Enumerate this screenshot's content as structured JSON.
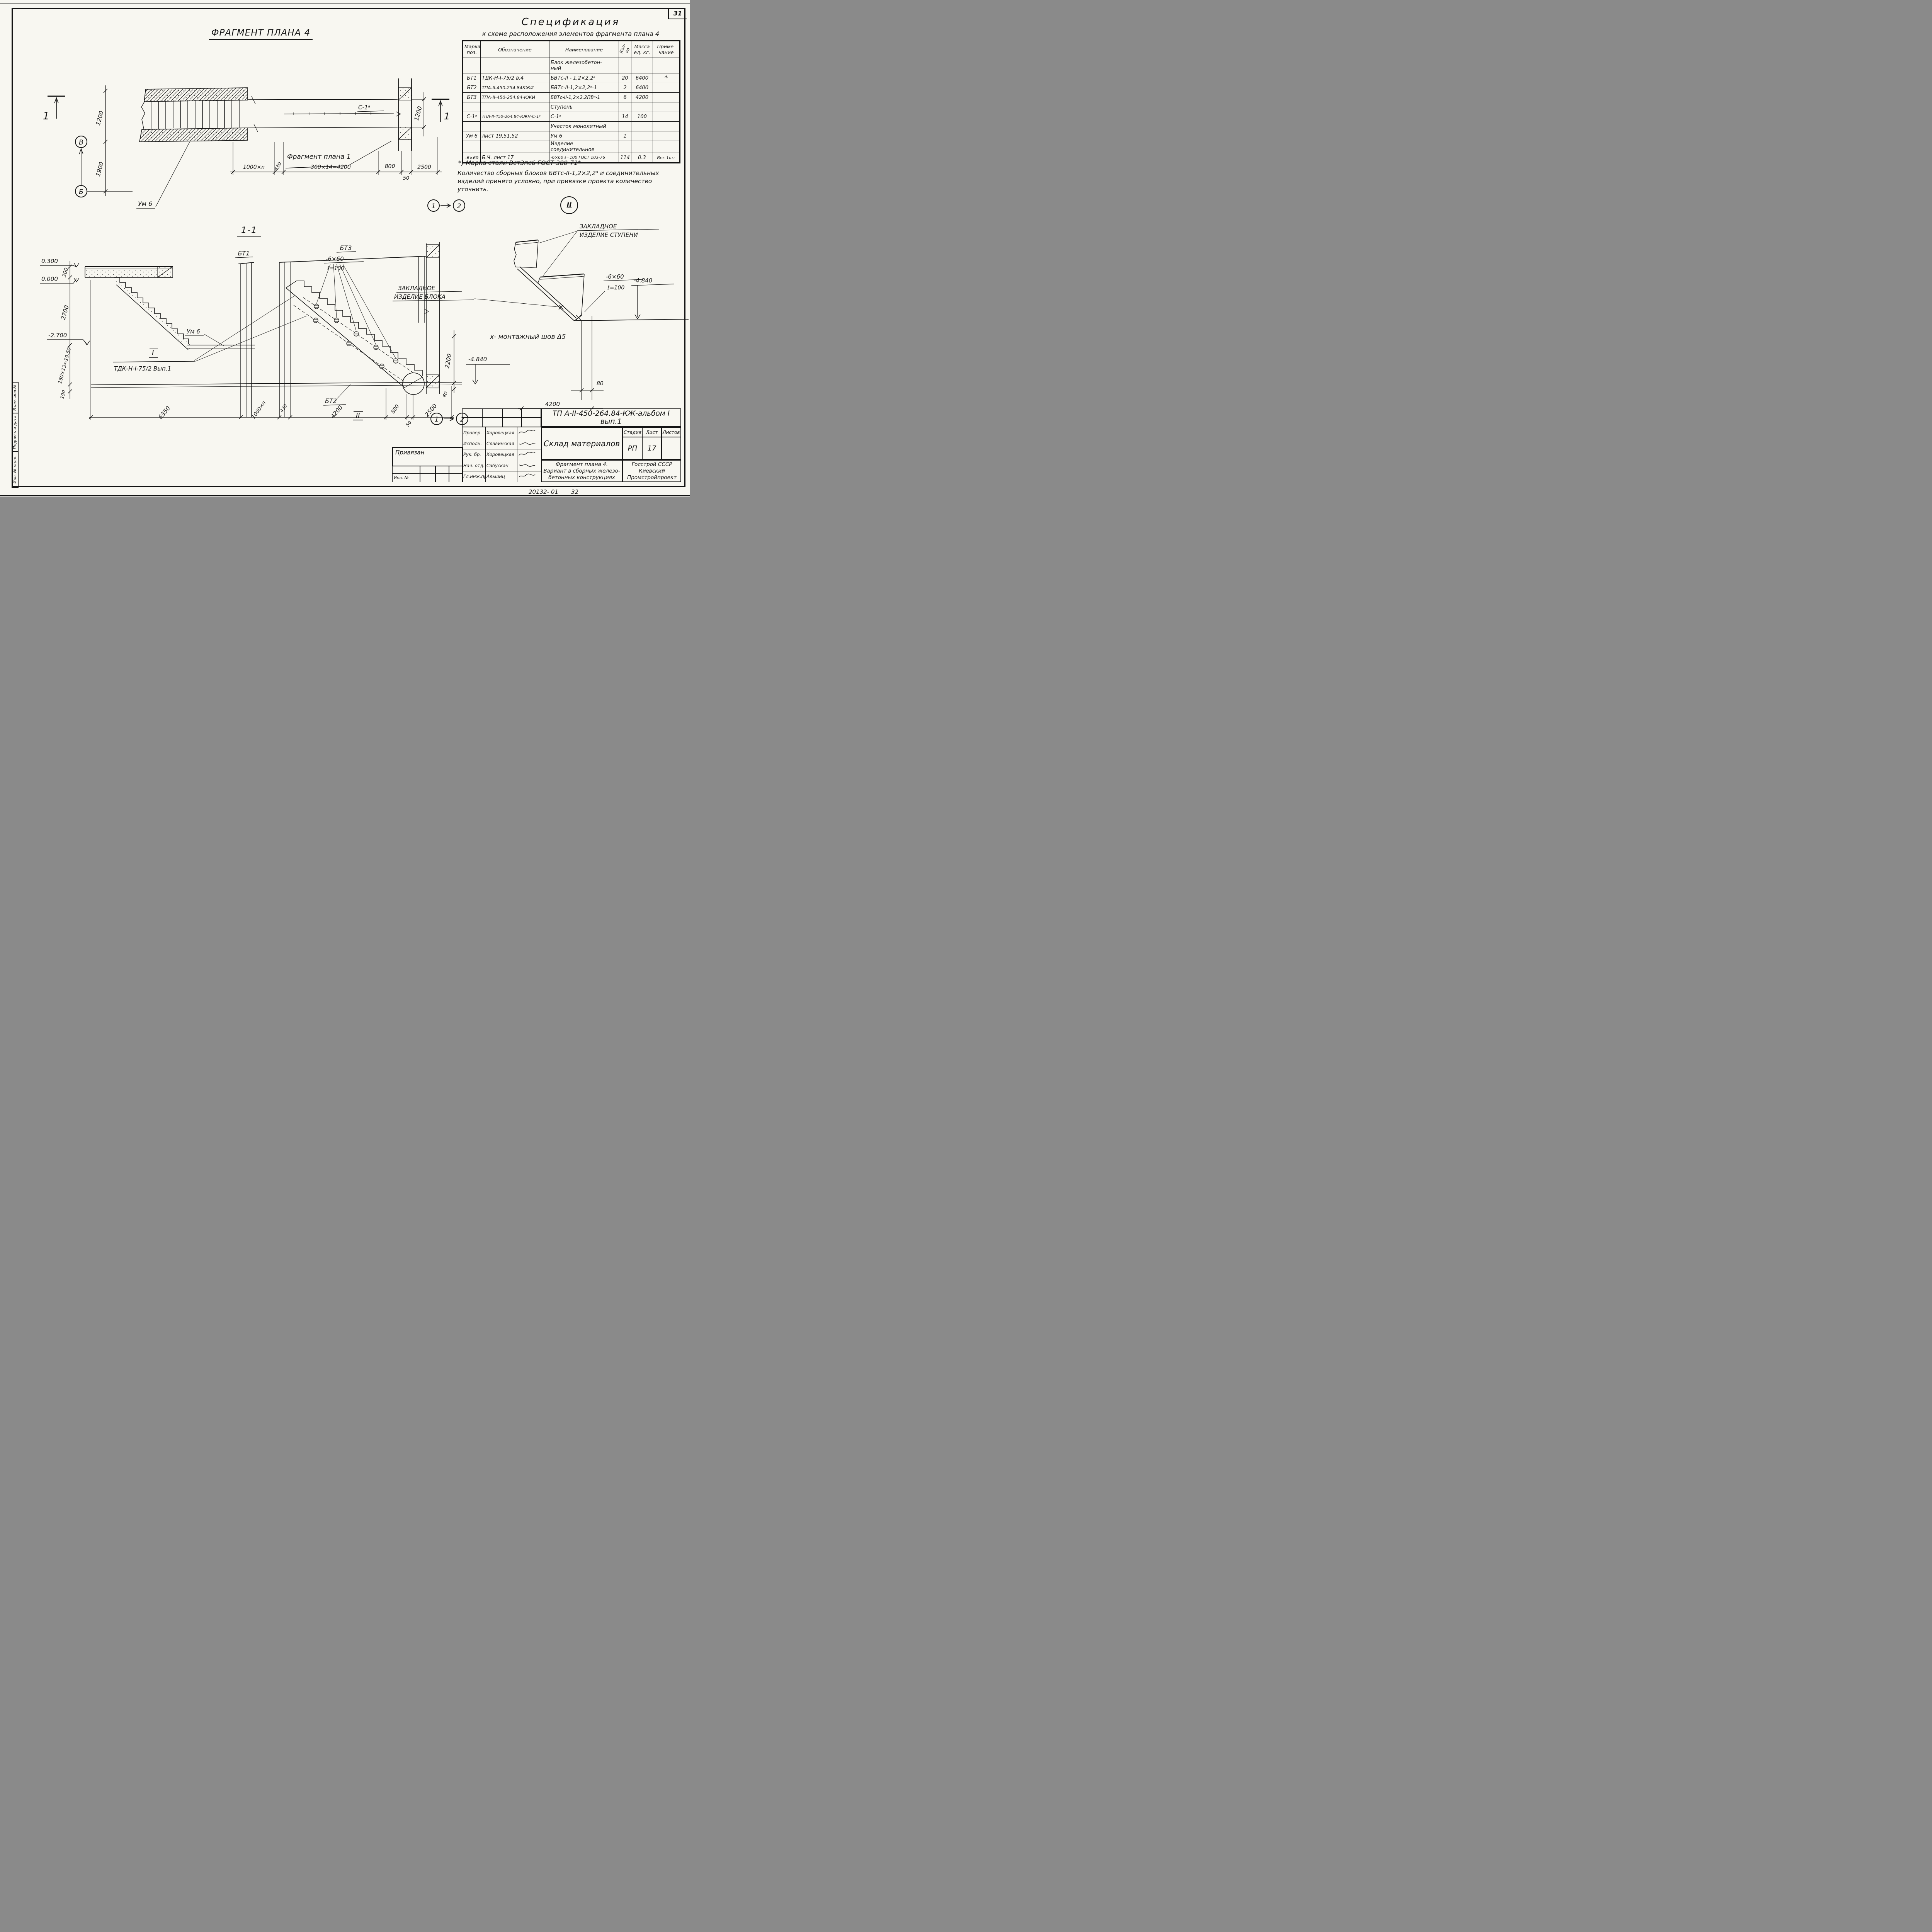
{
  "page": {
    "sheet_number": "31",
    "footer_doc": "20132- 01",
    "footer_page": "32"
  },
  "side_stamp": {
    "boxes": [
      "Взам. инв.№",
      "Подпись и дата",
      "Инв. № подл."
    ]
  },
  "markers": {
    "node1": "1",
    "node2": "2"
  },
  "plan": {
    "title": "ФРАГМЕНТ  ПЛАНА  4",
    "section_mark": "1",
    "axis_upper": "В",
    "axis_lower": "Б",
    "dim_width": "1200",
    "dim_axis": "1900",
    "dim_right": "1200",
    "label_um": "Ум 6",
    "label_s1": "С-1ᵃ",
    "label_fragment": "Фрагмент плана 1",
    "dims_bottom": [
      "1000×n",
      "430",
      "300×14=4200",
      "800",
      "50",
      "2500"
    ]
  },
  "spec": {
    "title": "Спецификация",
    "subtitle": "к схеме расположения элементов фрагмента плана 4",
    "col_marka": "Марка\nпоз.",
    "col_obozn": "Обозначение",
    "col_naimen": "Наименование",
    "col_kol": "Кол-во",
    "col_massa": "Масса\nед. кг.",
    "col_prim": "Приме-\nчание",
    "rows": [
      {
        "marka": "",
        "obozn": "",
        "naimen": "Блок железобетон-\nный",
        "kol": "",
        "massa": "",
        "prim": ""
      },
      {
        "marka": "БТ1",
        "obozn": "ТДК-Н-I-75/2 в.4",
        "naimen": "БВТс-II - 1,2×2,2ᵃ",
        "kol": "20",
        "massa": "6400",
        "prim": "*"
      },
      {
        "marka": "БТ2",
        "obozn": "ТПА-II-450-254.84КЖИ",
        "naimen": "БВТс-II-1,2×2,2ᵃ-1",
        "kol": "2",
        "massa": "6400",
        "prim": ""
      },
      {
        "marka": "БТ3",
        "obozn": "ТПА-II-450-254.84-КЖИ",
        "naimen": "БВТс-II-1,2×2,2ПВᵃ-1",
        "kol": "6",
        "massa": "4200",
        "prim": ""
      },
      {
        "marka": "",
        "obozn": "",
        "naimen": "Ступень",
        "kol": "",
        "massa": "",
        "prim": ""
      },
      {
        "marka": "С-1ᵃ",
        "obozn": "ТПА-II-450-264.84-КЖН-С-1ᵃ",
        "naimen": "С-1ᵃ",
        "kol": "14",
        "massa": "100",
        "prim": ""
      },
      {
        "marka": "",
        "obozn": "",
        "naimen": "Участок монолитный",
        "kol": "",
        "massa": "",
        "prim": ""
      },
      {
        "marka": "Ум 6",
        "obozn": "лист 19,51,52",
        "naimen": "Ум 6",
        "kol": "1",
        "massa": "",
        "prim": ""
      },
      {
        "marka": "",
        "obozn": "",
        "naimen": "Изделие соединительное",
        "kol": "",
        "massa": "",
        "prim": ""
      },
      {
        "marka": "-6×60",
        "obozn": "Б.Ч. лист 17",
        "naimen": "-6×60 ℓ=100 ГОСТ 103-76",
        "kol": "114",
        "massa": "0.3",
        "prim": "Вес 1шт"
      }
    ],
    "footnote": "*) Марка стали Вст3пс6 ГОСТ 380-71*",
    "note": "Количество сборных блоков БВТс-II-1,2×2,2ᵃ и соединительных изделий принято условно, при привязке проекта количество уточнить.",
    "detail_marker": "II"
  },
  "section": {
    "title": "1-1",
    "label_bt1": "БТ1",
    "label_bt3": "БТ3",
    "label_bt2": "БТ2",
    "callout_l1": "-6×60",
    "callout_l2": "ℓ=100",
    "elev_0300": "0.300",
    "elev_0000": "0.000",
    "elev_m2700": "-2.700",
    "elev_m4840": "-4.840",
    "dim_300": "300",
    "dim_2700": "2700",
    "dim_1950": "150×13=19.50",
    "dim_190": "190",
    "dim_2200": "2200",
    "dim_40": "40",
    "label_um": "Ум 6",
    "detail1_mark": "I",
    "detail1_ref": "ТДК-Н-I-75/2 Вып.1",
    "detail2_mark": "II",
    "dims_bottom": [
      "6350",
      "1000×n",
      "430",
      "4200",
      "800",
      "50",
      "2500"
    ]
  },
  "detail": {
    "title_mark": "II",
    "label_step_l1": "ЗАКЛАДНОЕ",
    "label_step_l2": "ИЗДЕЛИЕ  СТУПЕНИ",
    "label_block_l1": "ЗАКЛАДНОЕ",
    "label_block_l2": "ИЗДЕЛИЕ  БЛОКА",
    "callout_l1": "-6×60",
    "callout_l2": "ℓ=100",
    "elev": "-4.840",
    "dim_80": "80",
    "dim_4200": "4200",
    "note": "х-  монтажный  шов  Δ5"
  },
  "titleblock": {
    "designation": "ТП А-II-450-264.84-КЖ-альбом I вып.1",
    "object": "Склад  материалов",
    "sheet_name_l1": "Фрагмент  плана 4.",
    "sheet_name_l2": "Вариант в сборных железо-",
    "sheet_name_l3": "бетонных конструкциях",
    "org_l1": "Госстрой СССР",
    "org_l2": "Киевский",
    "org_l3": "Промстройпроект",
    "stage_label": "Стадия",
    "sheet_label": "Лист",
    "sheets_label": "Листов",
    "stage": "РП",
    "sheet": "17",
    "sheets": "",
    "attached": "Привязан",
    "inv": "Инв. №",
    "roles": [
      {
        "role": "Провер.",
        "name": "Хоровецкая"
      },
      {
        "role": "Исполн.",
        "name": "Славинская"
      },
      {
        "role": "Рук. бр.",
        "name": "Хоровецкая"
      },
      {
        "role": "Нач. отд.",
        "name": "Сабускан"
      },
      {
        "role": "Гл.инж.пр.",
        "name": "Альшиц"
      }
    ]
  }
}
